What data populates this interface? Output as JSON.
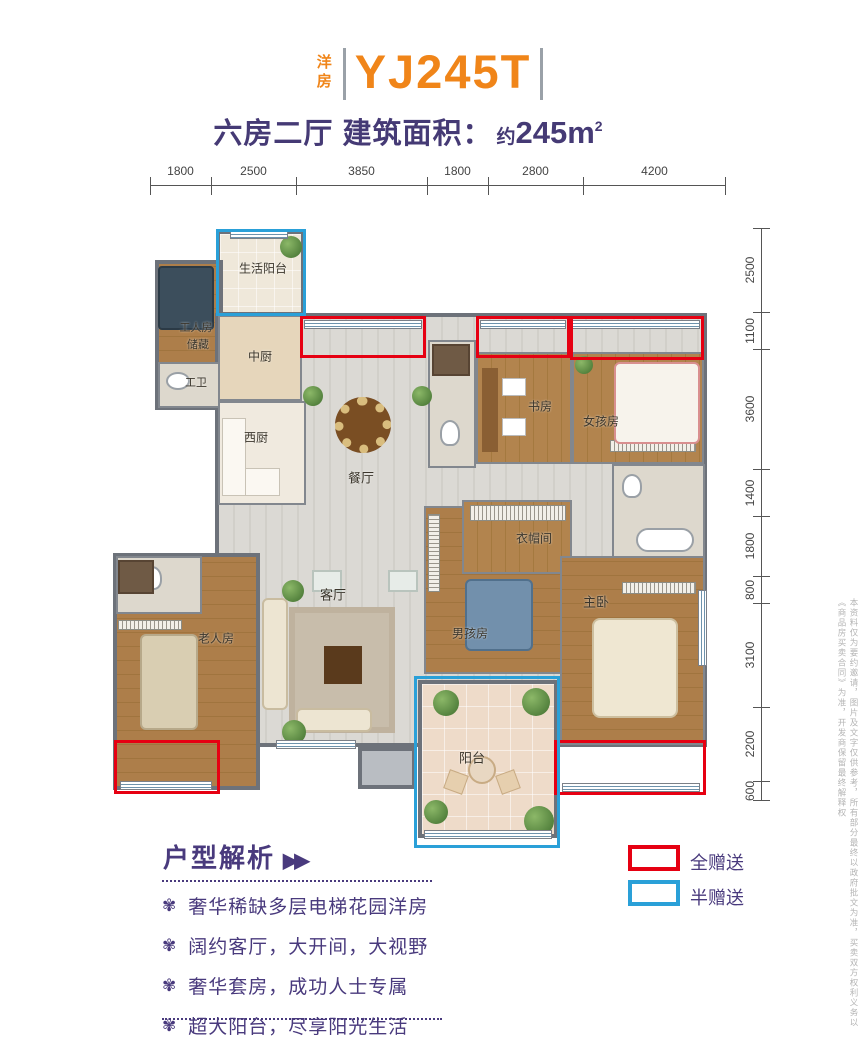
{
  "header": {
    "series_label": "洋房",
    "model_code": "YJ245T",
    "subtitle_layout": "六房二厅 建筑面积：",
    "subtitle_area_approx": "约",
    "subtitle_area_value": "245m",
    "subtitle_area_sup": "2"
  },
  "dimensions": {
    "top": [
      "1800",
      "2500",
      "3850",
      "1800",
      "2800",
      "4200"
    ],
    "right": [
      "2500",
      "1100",
      "3600",
      "1400",
      "1800",
      "800",
      "3100",
      "2200",
      "600"
    ]
  },
  "rooms": {
    "laundry": "生活阳台",
    "worker": "工人房",
    "storage": "储藏",
    "worker_bath": "工卫",
    "kitchen_cn": "中厨",
    "kitchen_west": "西厨",
    "dining": "餐厅",
    "study": "书房",
    "girl": "女孩房",
    "closet": "衣帽间",
    "master": "主卧",
    "boy": "男孩房",
    "living": "客厅",
    "elder": "老人房",
    "balcony": "阳台"
  },
  "legend": {
    "full_gift": "全赠送",
    "half_gift": "半赠送"
  },
  "analysis": {
    "title": "户型解析",
    "arrows": "▶▶",
    "bullet_icon": "✾",
    "items": [
      "奢华稀缺多层电梯花园洋房",
      "阔约客厅，大开间，大视野",
      "奢华套房，成功人士专属",
      "超大阳台，尽享阳光生活"
    ]
  },
  "disclaimer": "本资料仅为要约邀请，图片及文字仅供参考，所有部分最终以政府批文为准，买卖双方权利义务以《商品房买卖合同》为准，开发商保留最终解释权",
  "colors": {
    "accent_orange": "#f08519",
    "accent_purple": "#493a7d",
    "gift_full_red": "#e60012",
    "gift_half_blue": "#2aa0d8"
  }
}
